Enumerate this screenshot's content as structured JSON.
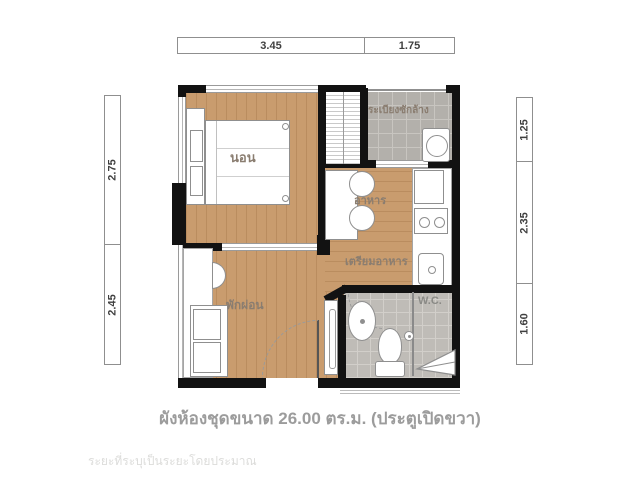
{
  "caption": "ผังห้องชุดขนาด 26.00 ตร.ม. (ประตูเปิดขวา)",
  "watermark": "ระยะที่ระบุเป็นระยะโดยประมาณ",
  "area_sqm": "26.00",
  "dims": {
    "top": [
      "3.45",
      "1.75"
    ],
    "left": [
      "2.75",
      "2.45"
    ],
    "right": [
      "1.25",
      "2.35",
      "1.60"
    ]
  },
  "rooms": {
    "bedroom": "นอน",
    "balcony": "ระเบียงซักล้าง",
    "dining": "อาหาร",
    "kitchen": "เตรียมอาหาร",
    "living": "พักผ่อน",
    "wc": "W.C."
  },
  "colors": {
    "wall": "#121212",
    "wood_floor": "#c99c6e",
    "balcony_tile": "#b3b0ab",
    "bath_tile": "#bfbcb7",
    "label_text": "#8a7d70",
    "caption_text": "#9c9c9c"
  }
}
